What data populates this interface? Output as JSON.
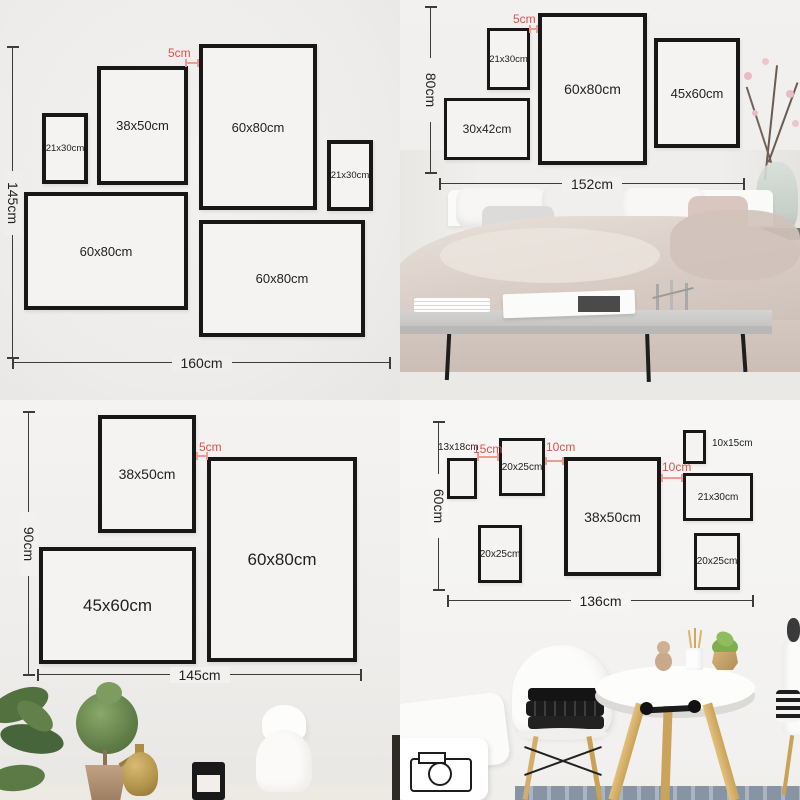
{
  "title": "Gallery wall picture frame size layout guide (4 layouts)",
  "colors": {
    "accent_red": "#d9534b",
    "frame_border": "#171717",
    "dimension_line": "#3c3c3c"
  },
  "quadrants": {
    "q1": {
      "name": "layout 160x145 on plain wall",
      "height_label": "145cm",
      "width_label": "160cm",
      "gap_label": "5cm",
      "frames": [
        {
          "label": "21x30cm"
        },
        {
          "label": "38x50cm"
        },
        {
          "label": "60x80cm"
        },
        {
          "label": "21x30cm"
        },
        {
          "label": "60x80cm"
        },
        {
          "label": "60x80cm"
        }
      ]
    },
    "q2": {
      "name": "layout 152x80 above bed",
      "height_label": "80cm",
      "width_label": "152cm",
      "gap_label": "5cm",
      "frames": [
        {
          "label": "21x30cm"
        },
        {
          "label": "30x42cm"
        },
        {
          "label": "60x80cm"
        },
        {
          "label": "45x60cm"
        }
      ]
    },
    "q3": {
      "name": "layout 145x90 above console",
      "height_label": "90cm",
      "width_label": "145cm",
      "gap_label": "5cm",
      "frames": [
        {
          "label": "38x50cm"
        },
        {
          "label": "60x80cm"
        },
        {
          "label": "45x60cm"
        }
      ]
    },
    "q4": {
      "name": "layout 136x60 above dining table",
      "height_label": "60cm",
      "width_label": "136cm",
      "gap_labels": [
        "15cm",
        "10cm",
        "10cm"
      ],
      "frames": [
        {
          "label": "13x18cm"
        },
        {
          "label": "20x25cm"
        },
        {
          "label": "38x50cm"
        },
        {
          "label": "10x15cm"
        },
        {
          "label": "21x30cm"
        },
        {
          "label": "20x25cm"
        },
        {
          "label": "20x25cm"
        }
      ]
    }
  }
}
